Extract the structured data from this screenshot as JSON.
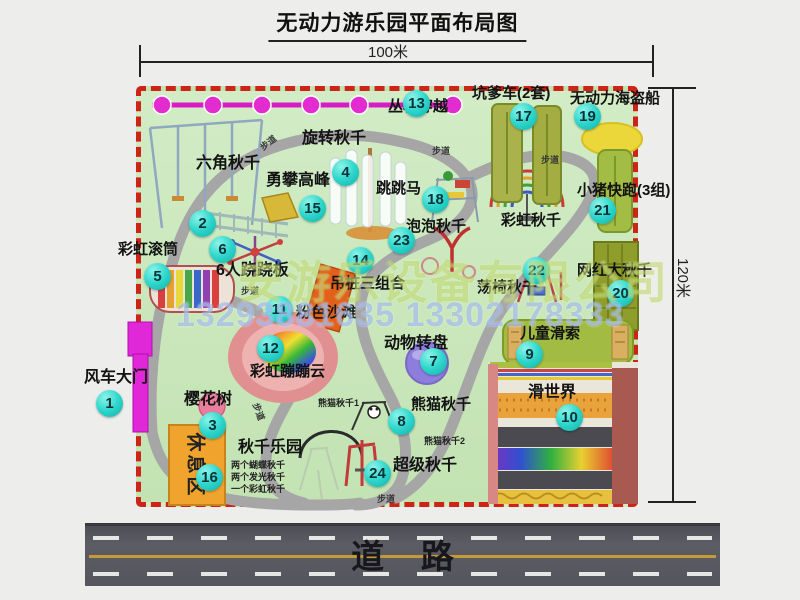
{
  "title": "无动力游乐园平面布局图",
  "dimensions": {
    "width_label": "100米",
    "height_label": "120米"
  },
  "road_label": "道    路",
  "watermark": {
    "company": "安游乐设备有限公司",
    "phone": "13293881635 13302178333"
  },
  "colors": {
    "badge": "#2fd6cb",
    "map_border": "#ce2418",
    "map_bg": "#c9e7bb",
    "zipline": "#d81bc4",
    "road": "#55555d",
    "rest_area": "#f0a42e"
  },
  "map": {
    "rest_area": "休息区",
    "path_label": "步道",
    "extra_labels": [
      {
        "id": "rainbow-swing",
        "label": "彩虹秋千"
      }
    ],
    "items": [
      {
        "num": "1",
        "label": "风车大门"
      },
      {
        "num": "2",
        "label": "六角秋千"
      },
      {
        "num": "3",
        "label": "樱花树"
      },
      {
        "num": "4",
        "label": "旋转秋千"
      },
      {
        "num": "5",
        "label": "彩虹滚筒"
      },
      {
        "num": "6",
        "label": "6人跷跷板"
      },
      {
        "num": "7",
        "label": "动物转盘"
      },
      {
        "num": "8",
        "label": "熊猫秋千",
        "sublabels": [
          "熊猫秋千1",
          "熊猫秋千2"
        ]
      },
      {
        "num": "9",
        "label": "儿童滑索"
      },
      {
        "num": "10",
        "label": "滑世界"
      },
      {
        "num": "11",
        "label": "粉色沙滩"
      },
      {
        "num": "12",
        "label": "彩虹蹦蹦云"
      },
      {
        "num": "13",
        "label": "丛林穿越"
      },
      {
        "num": "14",
        "label": "吊桩三组合"
      },
      {
        "num": "15",
        "label": "勇攀高峰"
      },
      {
        "num": "16",
        "label": "秋千乐园",
        "sublabels": [
          "两个蝴蝶秋千",
          "两个发光秋千",
          "一个彩虹秋千"
        ]
      },
      {
        "num": "17",
        "label": "坑爹车(2套)"
      },
      {
        "num": "18",
        "label": "跳跳马"
      },
      {
        "num": "19",
        "label": "无动力海盗船"
      },
      {
        "num": "20",
        "label": "网红大秋千"
      },
      {
        "num": "21",
        "label": "小猪快跑(3组)"
      },
      {
        "num": "22",
        "label": "荡椅秋千"
      },
      {
        "num": "23",
        "label": "泡泡秋千"
      },
      {
        "num": "24",
        "label": "超级秋千"
      }
    ]
  }
}
